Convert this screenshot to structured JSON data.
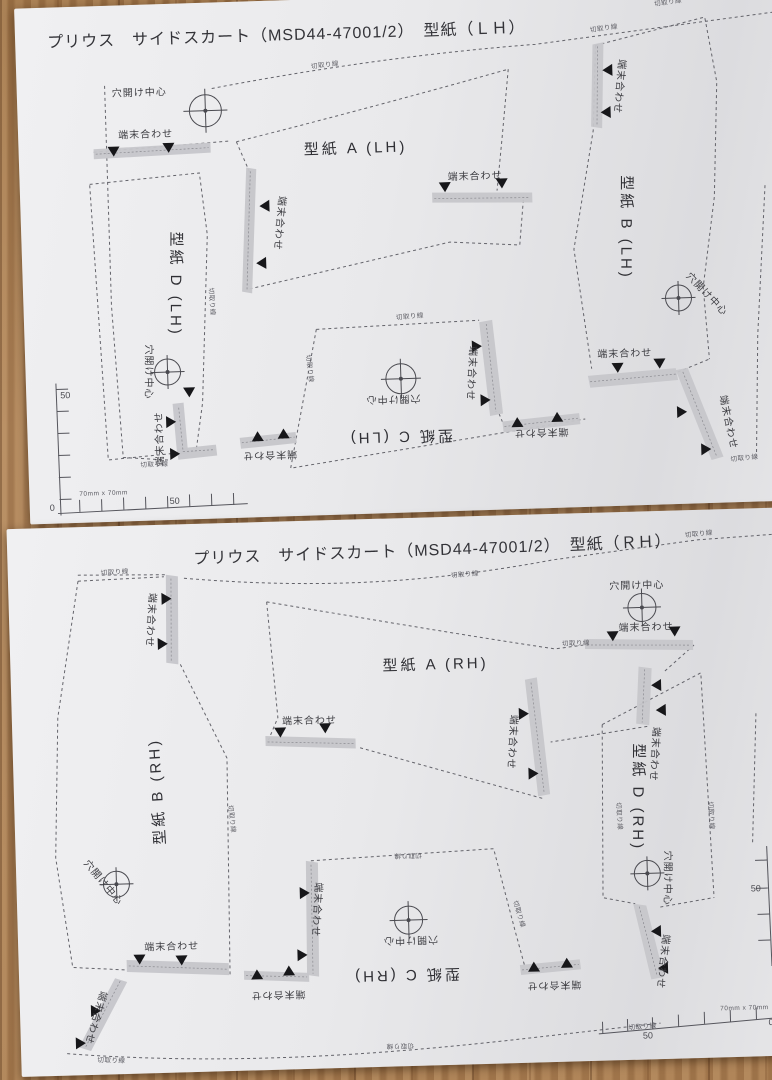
{
  "labels": {
    "hole_center": "穴開け中心",
    "edge_align": "端末合わせ",
    "cut_line": "切取り線",
    "grid_note": "70mm x 70mm",
    "ruler_zero": "0",
    "ruler_fifty": "50"
  },
  "sheet_lh": {
    "title": "プリウス　サイドスカート（MSD44-47001/2）　型紙（ＬＨ）",
    "pieces": {
      "a": "型紙 A (LH)",
      "b": "型紙 B (LH)",
      "c": "型紙 C (LH)",
      "d": "型紙 D (LH)"
    }
  },
  "sheet_rh": {
    "title": "プリウス　サイドスカート（MSD44-47001/2）　型紙（ＲＨ）",
    "pieces": {
      "a": "型紙 A (RH)",
      "b": "型紙 B (RH)",
      "c": "型紙 C (RH)",
      "d": "型紙 D (RH)"
    }
  },
  "colors": {
    "paper": "#e9e9eb",
    "wood": "#a97e53",
    "line": "#63636a",
    "strip": "#c6c6ca",
    "marker": "#17171a"
  }
}
